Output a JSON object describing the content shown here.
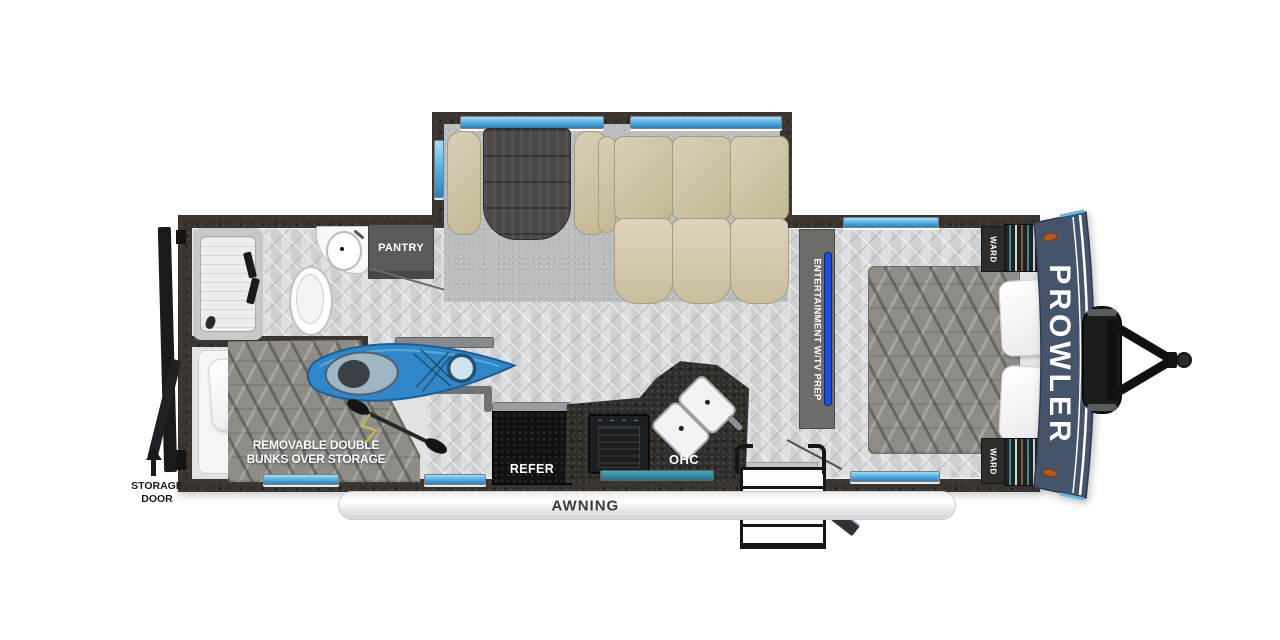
{
  "title": "Prowler travel trailer floor plan",
  "labels": {
    "storage_door": "STORAGE DOOR",
    "bunks": "REMOVABLE DOUBLE BUNKS OVER STORAGE",
    "pantry": "PANTRY",
    "refer": "REFER",
    "ohc": "OHC",
    "entertainment": "ENTERTAINMENT W/TV PREP",
    "ward_top": "WARD",
    "ward_bottom": "WARD",
    "awning": "AWNING",
    "brand": "PROWLER"
  },
  "colors": {
    "wall": "#3a3430",
    "floor": "#d7d9db",
    "slide_carpet": "#b9bdc0",
    "cushion_tan": "#cdc2a6",
    "table_wood": "#4b4846",
    "counter_granite": "#312f2c",
    "front_cap_navy": "#46546b",
    "window_blue": "#5ab4e4",
    "kitchen_window_teal": "#3d8ba0",
    "kayak_blue": "#2f86c8",
    "marker_light_orange": "#b65a1c"
  }
}
